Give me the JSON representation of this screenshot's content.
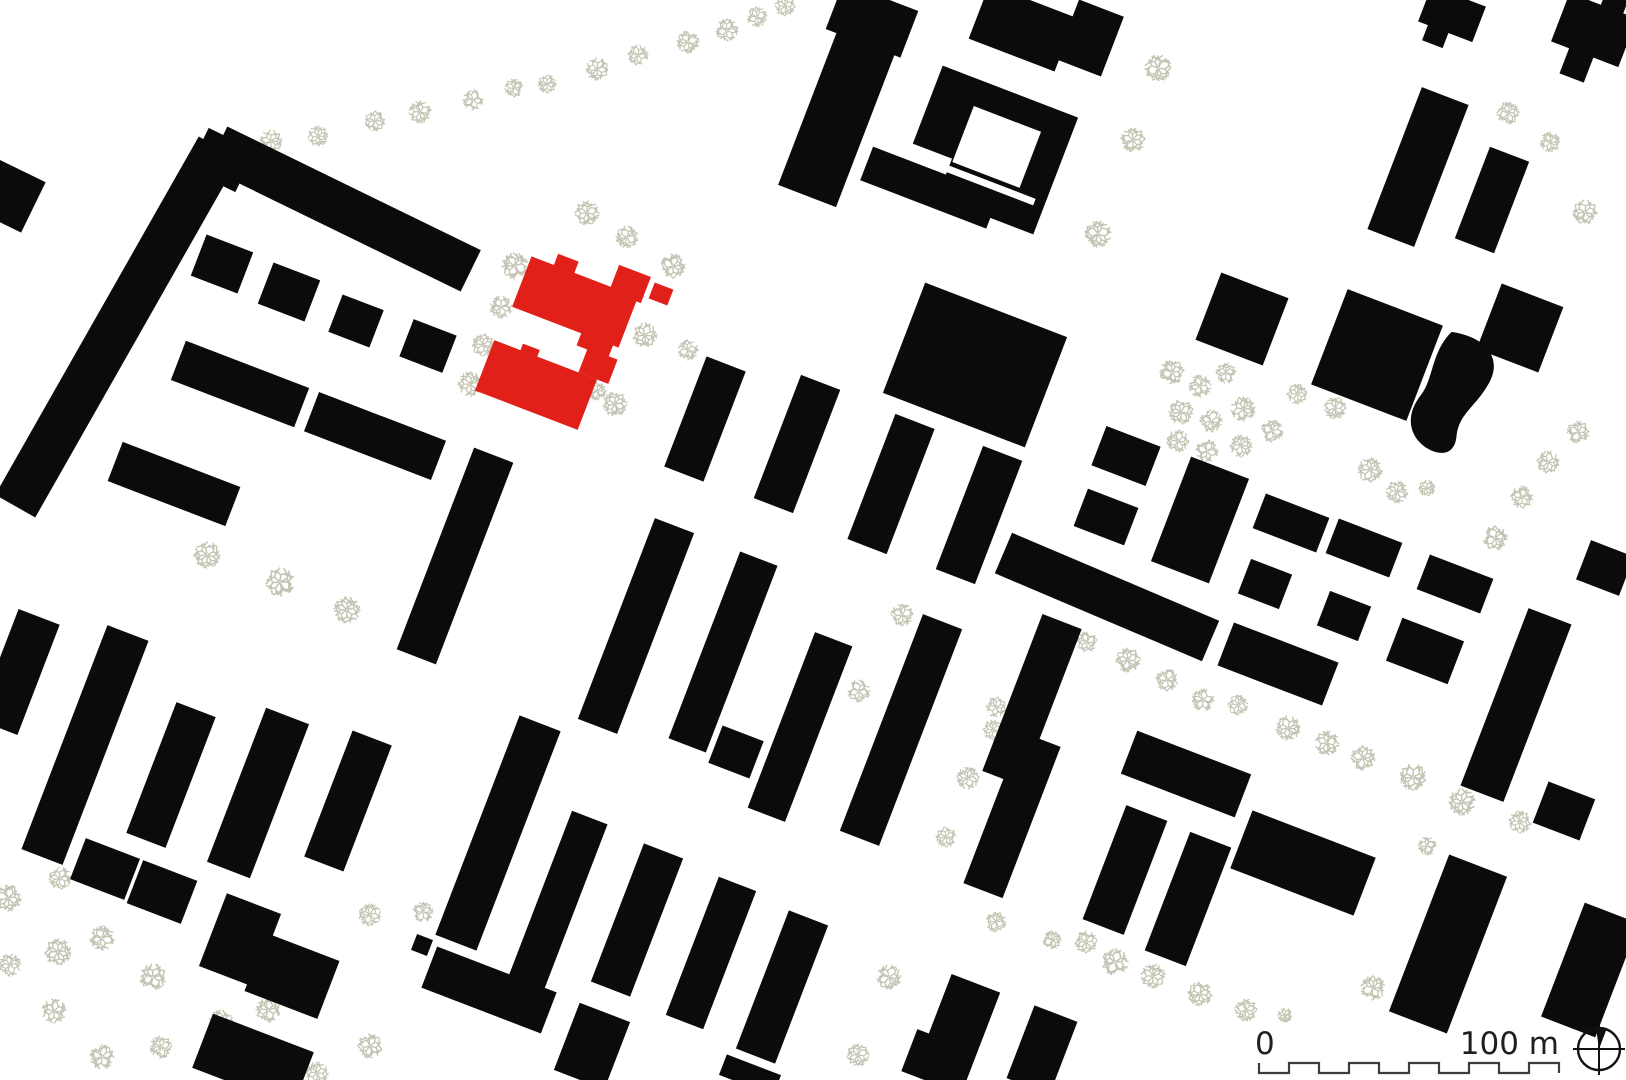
{
  "page": {
    "kind": "architectural figure-ground site plan",
    "background": "#ffffff"
  },
  "colors": {
    "building": "#0b0b0b",
    "highlight": "#e1201a",
    "tree": "#c4c4b3",
    "scalebar_line": "#3c3c3c",
    "label_text": "#1f1f1f",
    "background": "#ffffff"
  },
  "scale_bar": {
    "zero_label": "0",
    "distance_label": "100 m",
    "segments": 10,
    "length_px": 300
  },
  "map": {
    "grid_rotation_deg": 21,
    "buildings": [
      [
        117,
        327,
        412,
        46,
        -60.4,
        "b"
      ],
      [
        222,
        160,
        52,
        46,
        26,
        "b"
      ],
      [
        344,
        209,
        282,
        46,
        26,
        "b"
      ],
      [
        10,
        196,
        52,
        56,
        26,
        "b"
      ],
      [
        18,
        672,
        44,
        118,
        21,
        "b"
      ],
      [
        222,
        264,
        50,
        44,
        21,
        "b"
      ],
      [
        289,
        292,
        50,
        44,
        21,
        "b"
      ],
      [
        356,
        321,
        44,
        40,
        21,
        "b"
      ],
      [
        428,
        346,
        46,
        40,
        21,
        "b"
      ],
      [
        240,
        384,
        132,
        42,
        21,
        "b"
      ],
      [
        375,
        436,
        136,
        42,
        21,
        "b"
      ],
      [
        174,
        484,
        126,
        42,
        21,
        "b"
      ],
      [
        455,
        556,
        42,
        216,
        21,
        "b"
      ],
      [
        85,
        745,
        44,
        240,
        21,
        "b"
      ],
      [
        171,
        775,
        42,
        140,
        21,
        "b"
      ],
      [
        258,
        793,
        46,
        165,
        21,
        "b"
      ],
      [
        348,
        801,
        42,
        135,
        21,
        "b"
      ],
      [
        105,
        869,
        58,
        44,
        21,
        "b"
      ],
      [
        162,
        892,
        58,
        46,
        21,
        "b"
      ],
      [
        240,
        940,
        58,
        78,
        21,
        "b"
      ],
      [
        292,
        976,
        78,
        62,
        21,
        "b"
      ],
      [
        253,
        1060,
        108,
        58,
        21,
        "b"
      ],
      [
        489,
        990,
        128,
        44,
        21,
        "b"
      ],
      [
        498,
        833,
        44,
        235,
        21,
        "b"
      ],
      [
        422,
        945,
        17,
        17,
        21,
        "b"
      ],
      [
        705,
        419,
        42,
        118,
        21,
        "b"
      ],
      [
        797,
        444,
        42,
        132,
        21,
        "b"
      ],
      [
        891,
        484,
        42,
        134,
        21,
        "b"
      ],
      [
        979,
        515,
        42,
        132,
        21,
        "b"
      ],
      [
        975,
        365,
        152,
        118,
        21,
        "b"
      ],
      [
        636,
        626,
        42,
        215,
        21,
        "b"
      ],
      [
        723,
        652,
        40,
        200,
        21,
        "b"
      ],
      [
        800,
        727,
        40,
        188,
        21,
        "b"
      ],
      [
        901,
        730,
        42,
        232,
        21,
        "b"
      ],
      [
        1032,
        700,
        42,
        168,
        21,
        "b"
      ],
      [
        1012,
        815,
        42,
        162,
        21,
        "b"
      ],
      [
        557,
        903,
        38,
        183,
        21,
        "b"
      ],
      [
        637,
        920,
        42,
        148,
        21,
        "b"
      ],
      [
        711,
        953,
        40,
        148,
        21,
        "b"
      ],
      [
        782,
        987,
        42,
        148,
        21,
        "b"
      ],
      [
        592,
        1046,
        54,
        72,
        21,
        "b"
      ],
      [
        958,
        1030,
        52,
        100,
        21,
        "b"
      ],
      [
        935,
        1060,
        55,
        45,
        21,
        "b"
      ],
      [
        736,
        752,
        44,
        40,
        21,
        "b"
      ],
      [
        750,
        1075,
        58,
        22,
        21,
        "b"
      ],
      [
        1042,
        1050,
        46,
        78,
        21,
        "b"
      ],
      [
        842,
        105,
        62,
        195,
        21,
        "b"
      ],
      [
        872,
        20,
        80,
        50,
        21,
        "b"
      ],
      [
        988,
        150,
        145,
        125,
        21,
        "b",
        988,
        150
      ],
      [
        995,
        144,
        72,
        60,
        21,
        "w",
        988,
        150
      ],
      [
        930,
        196,
        55,
        50,
        21,
        "w",
        988,
        150
      ],
      [
        985,
        182,
        130,
        7,
        21,
        "w",
        988,
        150
      ],
      [
        947,
        206,
        135,
        36,
        21,
        "b",
        988,
        150
      ],
      [
        1022,
        28,
        92,
        58,
        21,
        "b"
      ],
      [
        1090,
        38,
        48,
        64,
        21,
        "b"
      ],
      [
        1418,
        167,
        50,
        152,
        21,
        "b"
      ],
      [
        1492,
        200,
        42,
        98,
        21,
        "b"
      ],
      [
        1452,
        14,
        58,
        38,
        21,
        "b"
      ],
      [
        1437,
        32,
        22,
        26,
        21,
        "b"
      ],
      [
        1594,
        30,
        72,
        52,
        21,
        "b"
      ],
      [
        1577,
        64,
        26,
        30,
        21,
        "b"
      ],
      [
        1614,
        4,
        24,
        22,
        21,
        "b"
      ],
      [
        1242,
        319,
        72,
        72,
        21,
        "b"
      ],
      [
        1377,
        355,
        102,
        102,
        21,
        "b"
      ],
      [
        1520,
        328,
        66,
        70,
        21,
        "b"
      ],
      [
        1126,
        456,
        58,
        42,
        21,
        "b"
      ],
      [
        1106,
        517,
        54,
        40,
        21,
        "b"
      ],
      [
        1200,
        520,
        62,
        112,
        21,
        "b"
      ],
      [
        1291,
        523,
        68,
        37,
        21,
        "b"
      ],
      [
        1364,
        548,
        68,
        37,
        21,
        "b"
      ],
      [
        1455,
        584,
        68,
        37,
        21,
        "b"
      ],
      [
        1265,
        584,
        44,
        37,
        21,
        "b"
      ],
      [
        1344,
        616,
        44,
        37,
        21,
        "b"
      ],
      [
        1107,
        597,
        225,
        44,
        23,
        "b"
      ],
      [
        1278,
        664,
        112,
        46,
        21,
        "b"
      ],
      [
        1425,
        651,
        66,
        46,
        21,
        "b"
      ],
      [
        1516,
        705,
        46,
        190,
        21,
        "b"
      ],
      [
        1605,
        568,
        46,
        42,
        21,
        "b"
      ],
      [
        1186,
        774,
        122,
        46,
        21,
        "b"
      ],
      [
        1125,
        870,
        44,
        122,
        21,
        "b"
      ],
      [
        1188,
        899,
        44,
        127,
        21,
        "b"
      ],
      [
        1303,
        863,
        132,
        62,
        21,
        "b"
      ],
      [
        1448,
        944,
        62,
        168,
        21,
        "b"
      ],
      [
        1564,
        811,
        50,
        44,
        21,
        "b"
      ],
      [
        1590,
        970,
        58,
        122,
        21,
        "b"
      ],
      [
        575,
        302,
        114,
        54,
        21,
        "r"
      ],
      [
        553,
        270,
        22,
        14,
        21,
        "r",
        575,
        302
      ],
      [
        609,
        329,
        34,
        26,
        21,
        "r",
        575,
        302
      ],
      [
        630,
        284,
        34,
        28,
        21,
        "r"
      ],
      [
        661,
        294,
        20,
        17,
        21,
        "r"
      ],
      [
        536,
        385,
        110,
        54,
        21,
        "r"
      ],
      [
        518,
        357,
        18,
        12,
        21,
        "r",
        536,
        385
      ],
      [
        598,
        366,
        32,
        26,
        21,
        "r"
      ]
    ],
    "pond": {
      "cx": 1457,
      "cy": 396,
      "rotation": 21,
      "path": "M -28,-58 C 8,-66 30,-50 25,-22 C 21,4 8,16 14,38 C 19,56 6,63 -12,59 C -33,53 -41,34 -34,12 C -28,-8 -40,-32 -28,-58 Z"
    },
    "trees": [
      [
        271,
        141,
        11
      ],
      [
        318,
        136,
        10
      ],
      [
        375,
        121,
        10
      ],
      [
        420,
        112,
        11
      ],
      [
        473,
        100,
        10
      ],
      [
        514,
        88,
        9
      ],
      [
        547,
        84,
        9
      ],
      [
        597,
        69,
        11
      ],
      [
        638,
        55,
        10
      ],
      [
        688,
        42,
        11
      ],
      [
        727,
        30,
        11
      ],
      [
        757,
        17,
        10
      ],
      [
        785,
        6,
        10
      ],
      [
        515,
        266,
        13
      ],
      [
        501,
        307,
        11
      ],
      [
        483,
        345,
        11
      ],
      [
        470,
        384,
        12
      ],
      [
        587,
        213,
        12
      ],
      [
        627,
        237,
        11
      ],
      [
        673,
        266,
        12
      ],
      [
        645,
        335,
        12
      ],
      [
        615,
        404,
        12
      ],
      [
        688,
        350,
        10
      ],
      [
        597,
        391,
        9
      ],
      [
        207,
        555,
        13
      ],
      [
        280,
        582,
        14
      ],
      [
        347,
        610,
        13
      ],
      [
        902,
        615,
        11
      ],
      [
        859,
        691,
        11
      ],
      [
        996,
        707,
        10
      ],
      [
        993,
        730,
        10
      ],
      [
        1158,
        68,
        13
      ],
      [
        1133,
        140,
        12
      ],
      [
        1098,
        234,
        13
      ],
      [
        1550,
        142,
        10
      ],
      [
        1585,
        212,
        12
      ],
      [
        1508,
        113,
        11
      ],
      [
        1172,
        372,
        12
      ],
      [
        1200,
        386,
        11
      ],
      [
        1226,
        373,
        10
      ],
      [
        1181,
        412,
        12
      ],
      [
        1211,
        421,
        11
      ],
      [
        1243,
        409,
        12
      ],
      [
        1178,
        441,
        11
      ],
      [
        1207,
        451,
        11
      ],
      [
        1241,
        446,
        11
      ],
      [
        1272,
        431,
        11
      ],
      [
        1297,
        394,
        10
      ],
      [
        1335,
        408,
        11
      ],
      [
        1370,
        470,
        12
      ],
      [
        1397,
        492,
        11
      ],
      [
        1427,
        488,
        8
      ],
      [
        1578,
        432,
        11
      ],
      [
        1548,
        462,
        11
      ],
      [
        1522,
        497,
        11
      ],
      [
        1495,
        538,
        12
      ],
      [
        1087,
        642,
        10
      ],
      [
        1128,
        660,
        12
      ],
      [
        1167,
        680,
        11
      ],
      [
        1203,
        700,
        11
      ],
      [
        1238,
        705,
        10
      ],
      [
        8,
        898,
        13
      ],
      [
        60,
        878,
        11
      ],
      [
        10,
        965,
        11
      ],
      [
        58,
        952,
        13
      ],
      [
        102,
        938,
        12
      ],
      [
        153,
        977,
        13
      ],
      [
        54,
        1011,
        12
      ],
      [
        161,
        1047,
        11
      ],
      [
        102,
        1057,
        12
      ],
      [
        221,
        1022,
        12
      ],
      [
        226,
        1062,
        11
      ],
      [
        317,
        1073,
        11
      ],
      [
        370,
        915,
        11
      ],
      [
        423,
        912,
        10
      ],
      [
        370,
        1046,
        12
      ],
      [
        268,
        1010,
        12
      ],
      [
        968,
        778,
        11
      ],
      [
        946,
        837,
        10
      ],
      [
        996,
        922,
        10
      ],
      [
        1052,
        940,
        9
      ],
      [
        889,
        977,
        12
      ],
      [
        858,
        1055,
        11
      ],
      [
        1288,
        728,
        12
      ],
      [
        1327,
        743,
        12
      ],
      [
        1363,
        758,
        12
      ],
      [
        1413,
        777,
        13
      ],
      [
        1462,
        802,
        13
      ],
      [
        1520,
        822,
        11
      ],
      [
        1427,
        846,
        9
      ],
      [
        1086,
        942,
        11
      ],
      [
        1115,
        962,
        13
      ],
      [
        1153,
        976,
        12
      ],
      [
        1200,
        994,
        12
      ],
      [
        1246,
        1010,
        11
      ],
      [
        1285,
        1015,
        7
      ],
      [
        1373,
        988,
        12
      ]
    ]
  }
}
